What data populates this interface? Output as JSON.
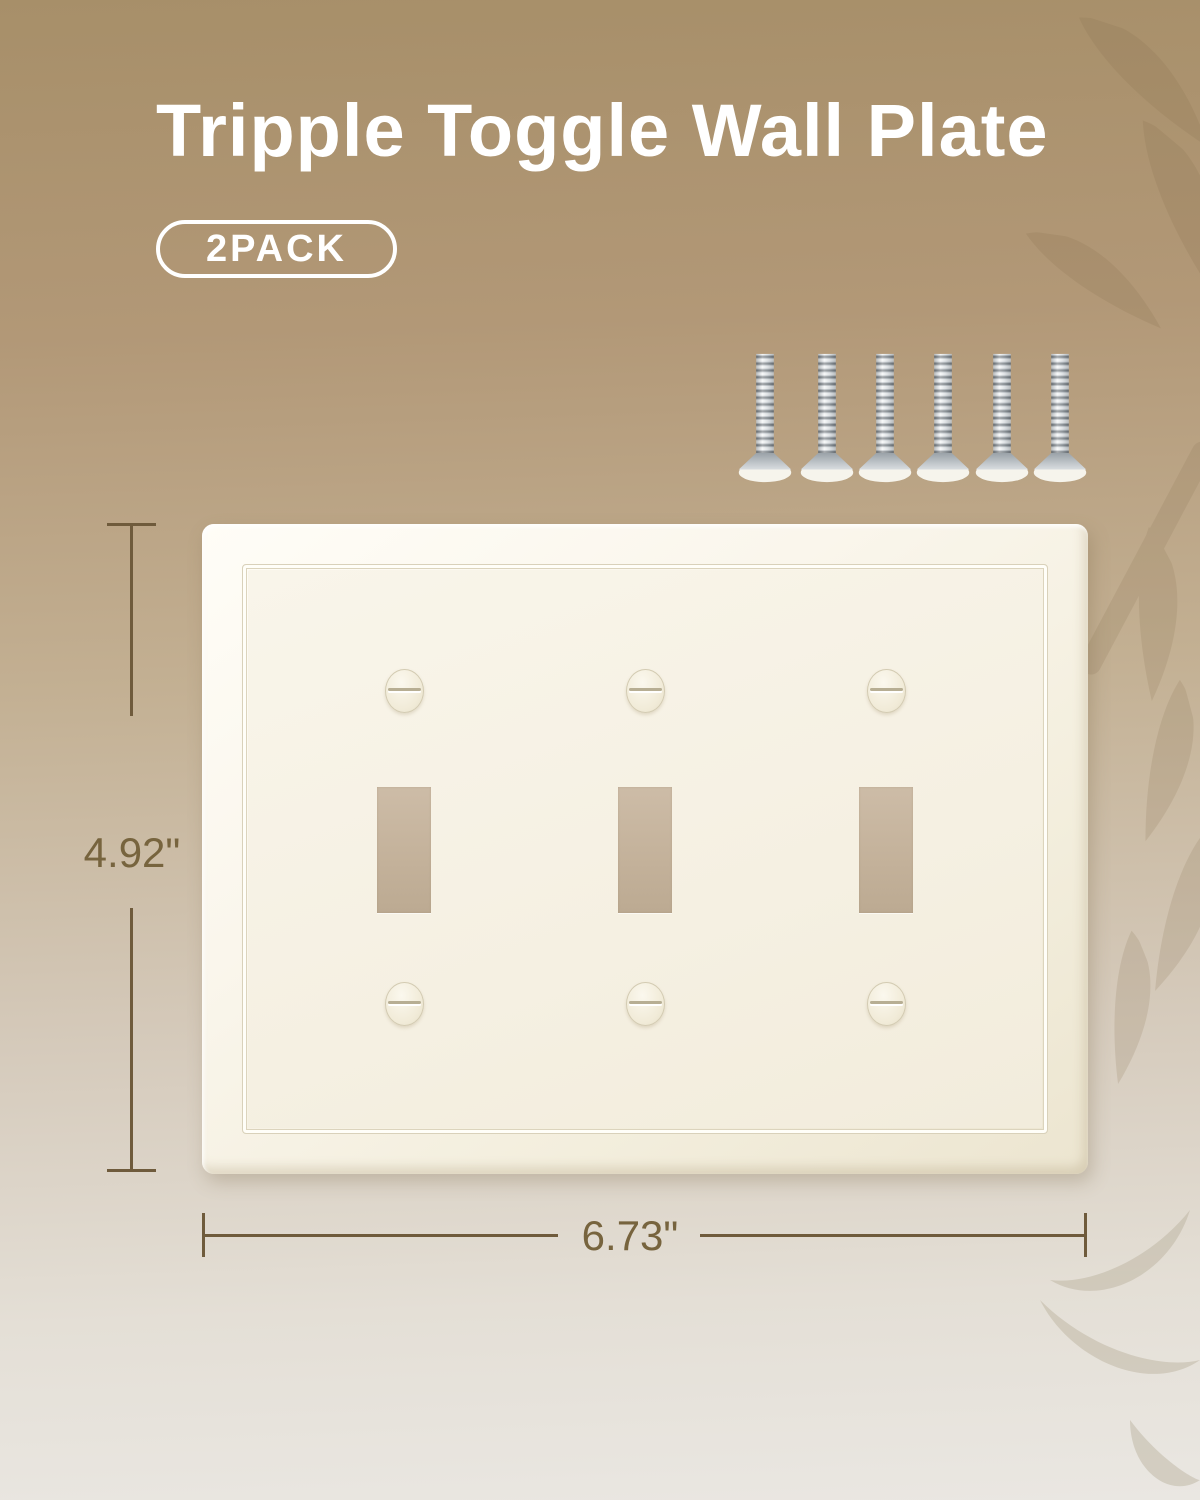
{
  "header": {
    "title": "Tripple Toggle Wall Plate",
    "badge": "2PACK"
  },
  "annotations": {
    "height": "4.92\"",
    "width": "6.73\""
  },
  "product": {
    "toggle_openings": 3,
    "plate_screws": 6,
    "loose_screws": 6
  },
  "colors": {
    "background_top": "#a78f69",
    "background_bottom": "#eae7e2",
    "plate_face": "#f5f0e2",
    "toggle_cutout": "#c4b29b",
    "dimension_line": "#6f5b3c",
    "dimension_text": "#77643e",
    "title_text": "#ffffff",
    "screw_metal": "#aeb4b9"
  }
}
